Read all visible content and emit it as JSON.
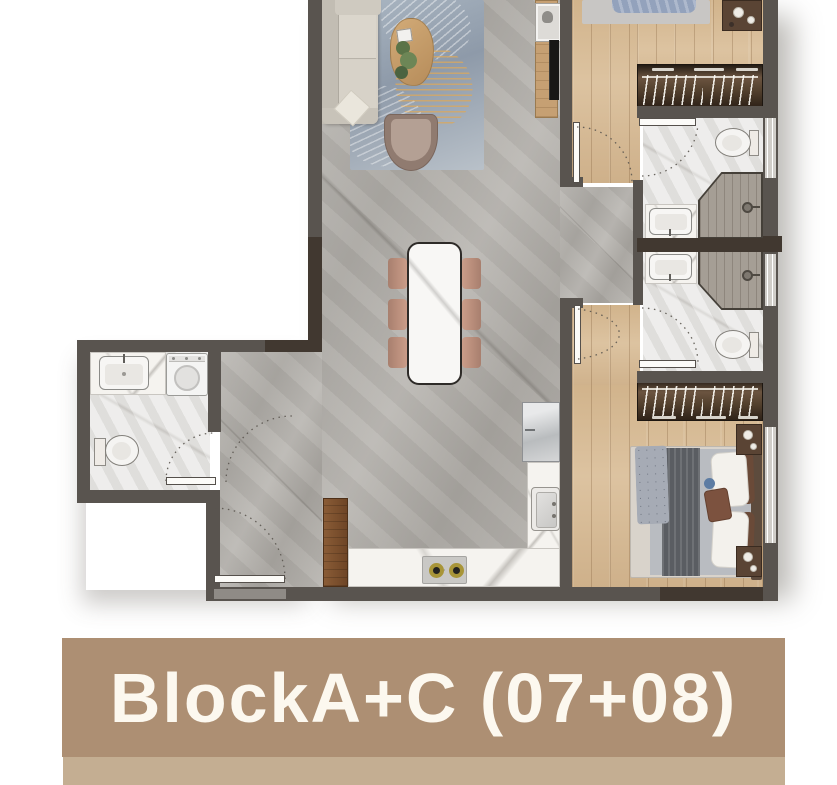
{
  "banner": {
    "label": "BlockA+C (07+08)"
  },
  "palette": {
    "banner_bg": "#ad8f73",
    "banner_strip": "#c4ae92",
    "banner_text": "#fcf8ef",
    "wall": "#59544f",
    "wall_dark": "#413830",
    "wood_floor": "#d9bd97",
    "marble_floor": "#b5b2ad",
    "bath_floor": "#e8e7e5",
    "counter_marble": "#f5f3ef"
  }
}
